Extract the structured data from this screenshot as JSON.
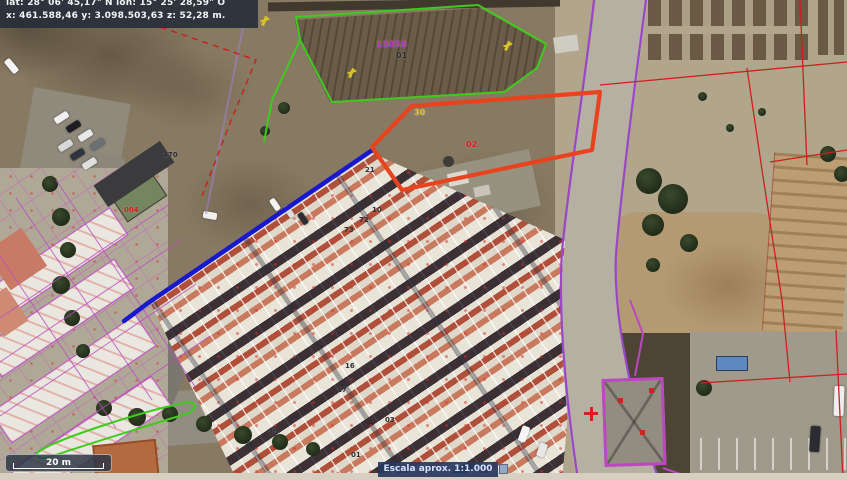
{
  "info_panel": {
    "line1": "lat: 28° 06' 45,17\" N   lon: 15° 25' 28,59\" O",
    "line2": "x: 461.588,46  y: 3.098.503,63  z: 52,28 m."
  },
  "scale_bar": {
    "label": "20 m"
  },
  "scale_indicator": {
    "label": "Escala aprox. 1:1.000"
  },
  "parcel_labels": [
    {
      "text": "15058",
      "color": "label_purple",
      "x": 376,
      "y": 41,
      "size": 9
    },
    {
      "text": "01",
      "color": "label_dark",
      "x": 396,
      "y": 52,
      "size": 8
    },
    {
      "text": "30",
      "color": "label_yellow",
      "x": 414,
      "y": 109,
      "size": 8
    },
    {
      "text": "02",
      "color": "label_red",
      "x": 466,
      "y": 141,
      "size": 8
    },
    {
      "text": "470",
      "color": "label_dark",
      "x": 163,
      "y": 152,
      "size": 7
    },
    {
      "text": "004",
      "color": "label_red",
      "x": 124,
      "y": 207,
      "size": 7
    },
    {
      "text": "21",
      "color": "label_dark",
      "x": 365,
      "y": 167,
      "size": 7
    },
    {
      "text": "10",
      "color": "label_dark",
      "x": 372,
      "y": 207,
      "size": 7
    },
    {
      "text": "72",
      "color": "label_dark",
      "x": 359,
      "y": 217,
      "size": 7
    },
    {
      "text": "73",
      "color": "label_dark",
      "x": 344,
      "y": 227,
      "size": 7
    },
    {
      "text": "16",
      "color": "label_dark",
      "x": 345,
      "y": 363,
      "size": 7
    },
    {
      "text": "17",
      "color": "label_dark",
      "x": 337,
      "y": 387,
      "size": 7
    },
    {
      "text": "20",
      "color": "label_dark",
      "x": 268,
      "y": 429,
      "size": 7
    },
    {
      "text": "01",
      "color": "label_dark",
      "x": 351,
      "y": 452,
      "size": 7
    },
    {
      "text": "03",
      "color": "label_dark",
      "x": 385,
      "y": 417,
      "size": 7
    }
  ],
  "pole_markers": [
    {
      "x": 263,
      "y": 16
    },
    {
      "x": 350,
      "y": 68
    },
    {
      "x": 506,
      "y": 41
    }
  ],
  "colors": {
    "selected_parcel_orange": "#e8431f",
    "boundary_green": "#3fcb1e",
    "street_edge_blue": "#1818cc",
    "road_boundary_purple": "#9a46c8",
    "cadastral_red": "#cc2020",
    "building_outline_magenta": "#bb48c0",
    "label_yellow": "#d8c428",
    "label_purple": "#b03ab8",
    "label_red": "#d42020",
    "label_dark": "#2e2e34",
    "panel_background": "#2a3442"
  }
}
